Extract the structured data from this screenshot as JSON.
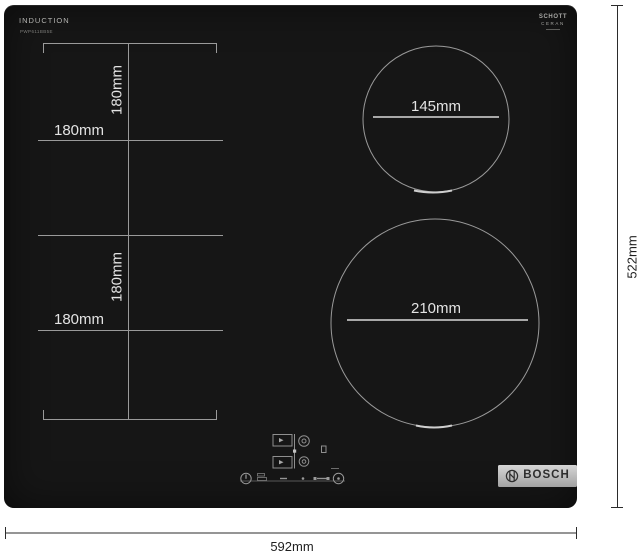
{
  "branding": {
    "induction_label": "INDUCTION",
    "model_text": "PWP611BB5E",
    "schott_logo_line1": "SCHOTT",
    "schott_logo_line2": "CERAN",
    "bosch_logo_text": "BOSCH"
  },
  "zone_labels": {
    "flex_top_vertical": "180mm",
    "flex_top_horizontal": "180mm",
    "flex_bottom_vertical": "180mm",
    "flex_bottom_horizontal": "180mm",
    "small_zone_diameter": "145mm",
    "large_zone_diameter": "210mm"
  },
  "overall_dimensions": {
    "width_label": "592mm",
    "height_label": "522mm"
  },
  "icons": {
    "power": "power-icon",
    "lock": "lock-icon",
    "zone_indicator": "zone-indicator-diagram",
    "bosch_emblem": "bosch-emblem-icon"
  },
  "colors": {
    "glass_panel": "#161616",
    "zone_outline": "#9a9a9a",
    "diameter_line": "#d9d9d9",
    "label_text": "#e3e3e3",
    "dimension_line": "#2b2b2b",
    "badge_background": "#b8b8b8"
  }
}
